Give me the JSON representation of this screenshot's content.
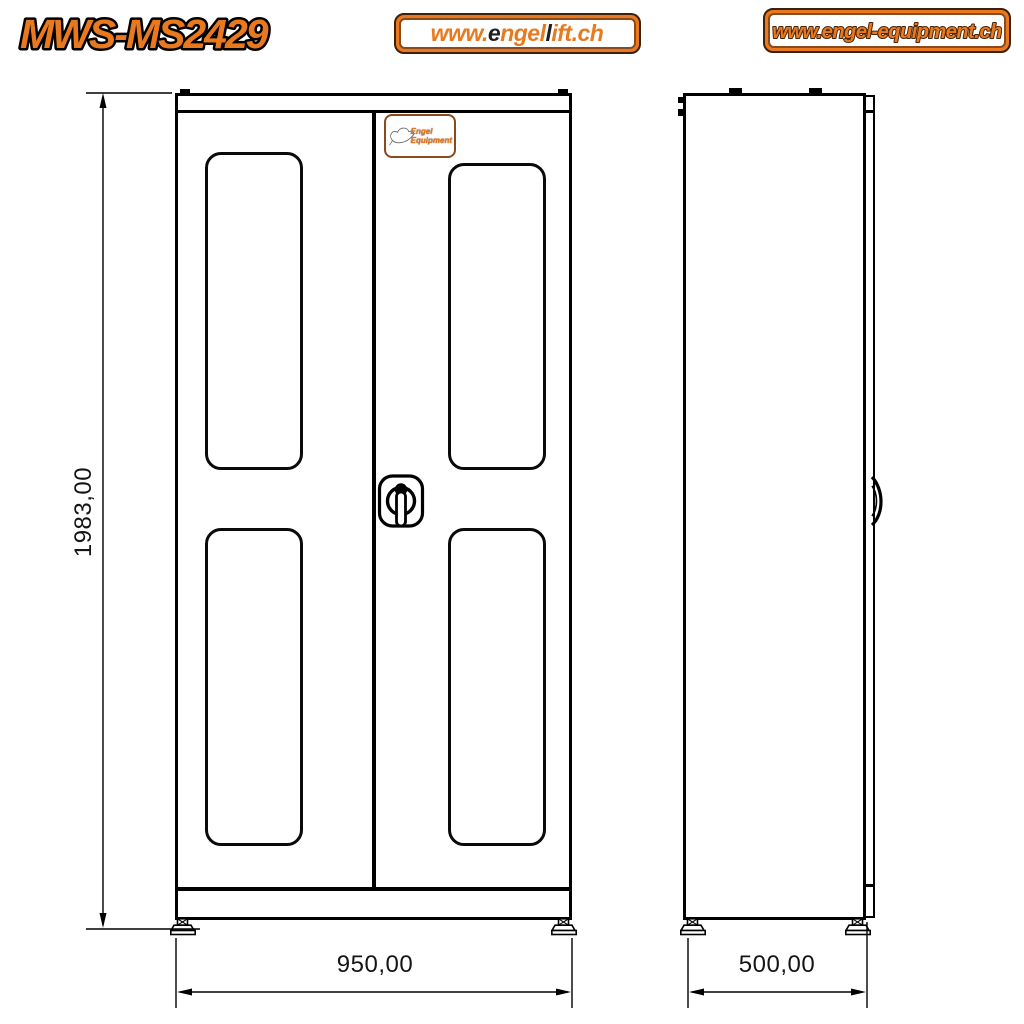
{
  "colors": {
    "accent": "#E8791E",
    "ink": "#000000",
    "plate_border": "#8A4A1C",
    "logo_dark": "#1F1F1F"
  },
  "header": {
    "model": "MWS-MS2429",
    "logo_engellift": {
      "label": "www.engellift.ch",
      "segments": [
        {
          "text": "www.",
          "tone": "accent"
        },
        {
          "text": "e",
          "tone": "dark"
        },
        {
          "text": "ngel",
          "tone": "accent"
        },
        {
          "text": "l",
          "tone": "dark"
        },
        {
          "text": "ift.ch",
          "tone": "accent"
        }
      ]
    },
    "logo_equipment": {
      "label": "www.engel-equipment.ch"
    }
  },
  "front_view": {
    "height_label": "1983,00",
    "width_label": "950,00",
    "door_plate": {
      "line1": "Engel",
      "line2": "Equipment"
    }
  },
  "side_view": {
    "depth_label": "500,00"
  }
}
